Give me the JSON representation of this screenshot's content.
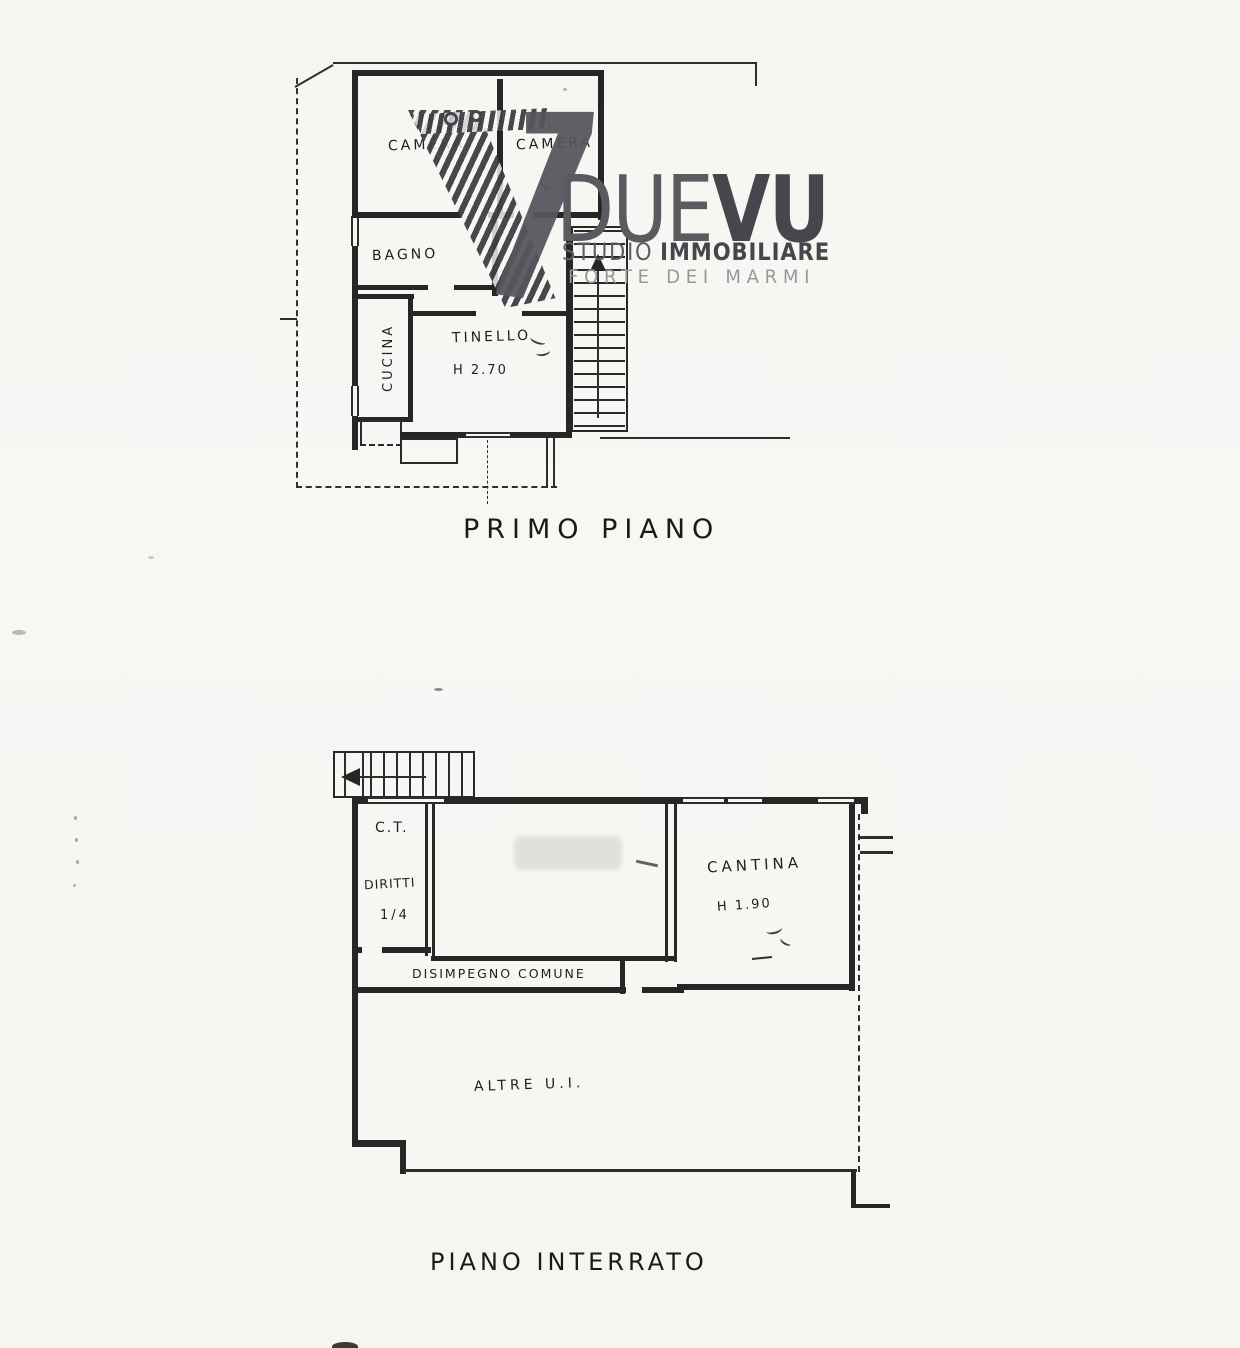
{
  "paper_color": "#f7f6f3",
  "ink_color": "#262626",
  "watermark": {
    "monogram_icon": "ornate-v-slash-monogram",
    "brand_due": "DUE",
    "brand_vu": "VU",
    "studio": "STUDIO",
    "immobiliare": "IMMOBILIARE",
    "location": "FORTE DEI MARMI",
    "dark_gray": "#505156",
    "light_gray": "#96979b"
  },
  "floors": [
    {
      "caption": "PRIMO PIANO",
      "rooms": {
        "camera_left": "CAMERA",
        "camera_right": "CAMERA",
        "bagno": "BAGNO",
        "cucina": "CUCINA",
        "tinello": "TINELLO",
        "tinello_height": "H 2.70"
      }
    },
    {
      "caption": "PIANO INTERRATO",
      "rooms": {
        "ct": "C.T.",
        "ct_note": "DIRITTI",
        "ct_fraction": "1/4",
        "cantina": "CANTINA",
        "cantina_height": "H 1.90",
        "corridor": "DISIMPEGNO COMUNE",
        "other_units": "ALTRE U.I."
      }
    }
  ]
}
